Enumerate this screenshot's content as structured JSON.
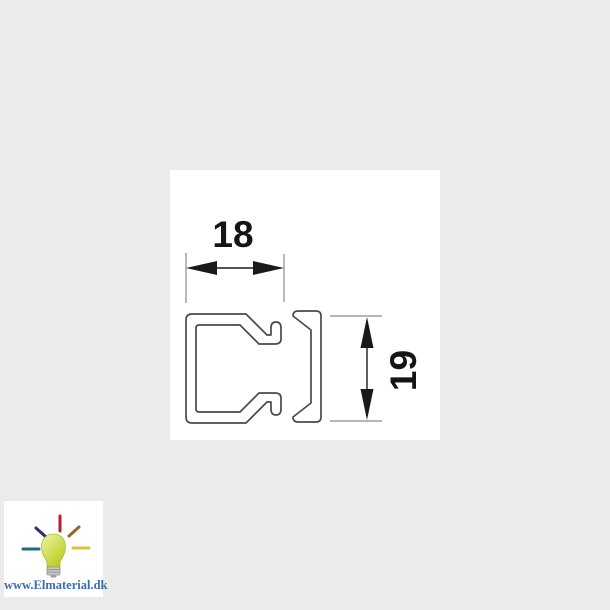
{
  "page": {
    "background_color": "#ebebeb",
    "panel_background": "#ffffff"
  },
  "drawing": {
    "type": "technical-cross-section",
    "subject": "cable trunking / mini-duct profile with base channel and lid",
    "line_color": "#4a4a4a",
    "dimension_color": "#1a1a1a",
    "extension_line_color": "#8a8a8a",
    "dimensions": {
      "width": {
        "value": "18",
        "orientation": "horizontal"
      },
      "height": {
        "value": "19",
        "orientation": "vertical"
      }
    }
  },
  "watermark": {
    "url_text": "www.Elmaterial.dk",
    "text_color": "#3a6db0",
    "bulb_color": "#c3d32e",
    "bulb_highlight": "#edf3ad",
    "base_color": "#c9c9c9",
    "ray_colors": {
      "top": "#b3202a",
      "top_left": "#332a6e",
      "top_right": "#9a6230",
      "left": "#1d6e79",
      "right": "#dfc23c"
    }
  }
}
